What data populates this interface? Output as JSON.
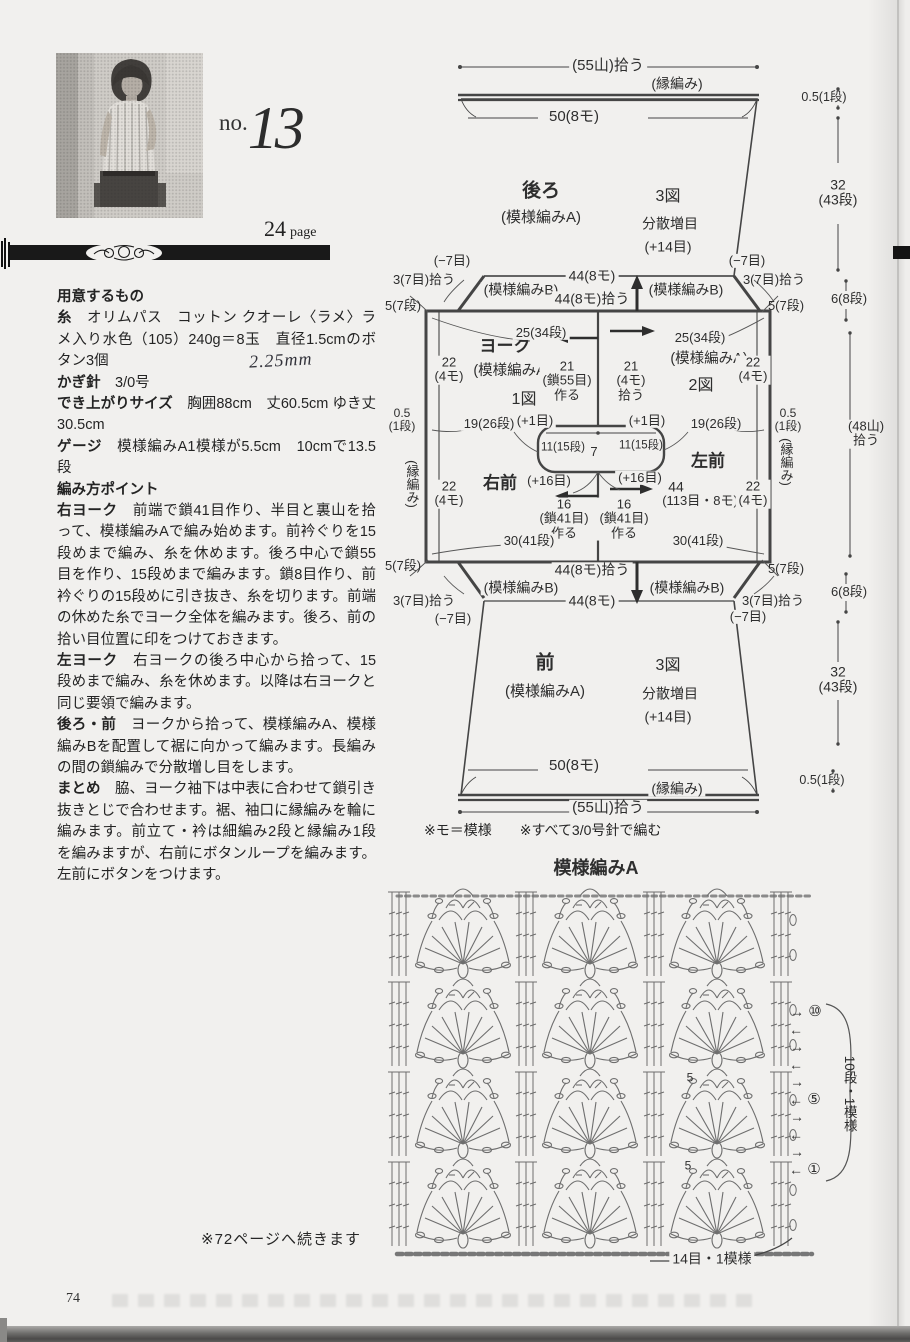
{
  "header": {
    "no_prefix": "no.",
    "no_number": "13",
    "page_ref_number": "24",
    "page_ref_label": "page"
  },
  "instructions": {
    "paragraphs": [
      {
        "h": "用意するもの"
      },
      {
        "b": "糸",
        "t": "　オリムパス　コットン クオーレ〈ラメ〉ラメ入り水色（105）240g＝8玉　直径1.5cmのボタン3個"
      },
      {
        "b": "かぎ針",
        "t": "　3/0号"
      },
      {
        "b": "でき上がりサイズ",
        "t": "　胸囲88cm　丈60.5cm ゆき丈30.5cm"
      },
      {
        "b": "ゲージ",
        "t": "　模様編みA1模様が5.5cm　10cmで13.5段"
      },
      {
        "h": "編み方ポイント"
      },
      {
        "b": "右ヨーク",
        "t": "　前端で鎖41目作り、半目と裏山を拾って、模様編みAで編み始めます。前衿ぐりを15段めまで編み、糸を休めます。後ろ中心で鎖55目を作り、15段めまで編みます。鎖8目作り、前衿ぐりの15段めに引き抜き、糸を切ります。前端の休めた糸でヨーク全体を編みます。後ろ、前の拾い目位置に印をつけておきます。"
      },
      {
        "b": "左ヨーク",
        "t": "　右ヨークの後ろ中心から拾って、15段めまで編み、糸を休めます。以降は右ヨークと同じ要領で編みます。"
      },
      {
        "b": "後ろ・前",
        "t": "　ヨークから拾って、模様編みA、模様編みBを配置して裾に向かって編みます。長編みの間の鎖編みで分散増し目をします。"
      },
      {
        "b": "まとめ",
        "t": "　脇、ヨーク袖下は中表に合わせて鎖引き抜きとじで合わせます。裾、袖口に縁編みを輪に編みます。前立て・衿は細編み2段と縁編み1段を編みますが、右前にボタンループを編みます。左前にボタンをつけます。"
      }
    ],
    "handwritten_note": "2.25mm"
  },
  "schematic": {
    "footnote": "※モ＝模様　　※すべて3/0号針で編む",
    "labels": [
      {
        "t": "(55山)拾う",
        "x": 608,
        "y": 66,
        "s": 15,
        "bg": 1
      },
      {
        "t": "(縁編み)",
        "x": 677,
        "y": 84,
        "s": 14,
        "bg": 1
      },
      {
        "t": "50(8モ)",
        "x": 574,
        "y": 117,
        "s": 15,
        "bg": 1
      },
      {
        "t": "後ろ",
        "x": 541,
        "y": 192,
        "s": 19,
        "b": 1
      },
      {
        "t": "(模様編みA)",
        "x": 541,
        "y": 218,
        "s": 15
      },
      {
        "t": "3図",
        "x": 668,
        "y": 197,
        "s": 16
      },
      {
        "t": "分散増目",
        "x": 670,
        "y": 224,
        "s": 14
      },
      {
        "t": "(+14目)",
        "x": 668,
        "y": 247,
        "s": 14
      },
      {
        "t": "0.5(1段)",
        "x": 824,
        "y": 98,
        "s": 12.5,
        "bg": 1
      },
      {
        "t": "32\n(43段)",
        "x": 838,
        "y": 193,
        "s": 14,
        "bg": 1
      },
      {
        "t": "(−7目)",
        "x": 452,
        "y": 261,
        "s": 13,
        "bg": 1
      },
      {
        "t": "(−7目)",
        "x": 747,
        "y": 261,
        "s": 13,
        "bg": 1
      },
      {
        "t": "44(8モ)",
        "x": 592,
        "y": 276,
        "s": 14,
        "bg": 1
      },
      {
        "t": "3(7目)拾う",
        "x": 424,
        "y": 280,
        "s": 13
      },
      {
        "t": "3(7目)拾う",
        "x": 774,
        "y": 280,
        "s": 13
      },
      {
        "t": "(模様編みB)",
        "x": 521,
        "y": 290,
        "s": 14,
        "bg": 1
      },
      {
        "t": "(模様編みB)",
        "x": 686,
        "y": 290,
        "s": 14,
        "bg": 1
      },
      {
        "t": "44(8モ)拾う",
        "x": 592,
        "y": 299,
        "s": 14,
        "bg": 1
      },
      {
        "t": "5(7段)",
        "x": 403,
        "y": 306,
        "s": 13
      },
      {
        "t": "5(7段)",
        "x": 786,
        "y": 306,
        "s": 13
      },
      {
        "t": "6(8段)",
        "x": 849,
        "y": 299,
        "s": 13,
        "bg": 1
      },
      {
        "t": "ヨーク",
        "x": 505,
        "y": 347,
        "s": 17,
        "b": 1
      },
      {
        "t": "(模様編みA)",
        "x": 512,
        "y": 372,
        "s": 14.5
      },
      {
        "t": "1図",
        "x": 524,
        "y": 400,
        "s": 16
      },
      {
        "t": "25(34段)",
        "x": 541,
        "y": 333,
        "s": 13,
        "bg": 1
      },
      {
        "t": "25(34段)",
        "x": 700,
        "y": 338,
        "s": 13,
        "bg": 1
      },
      {
        "t": "21\n(鎖55目)\n作る",
        "x": 567,
        "y": 381,
        "s": 13,
        "bg": 1
      },
      {
        "t": "21\n(4モ)\n拾う",
        "x": 631,
        "y": 381,
        "s": 13,
        "bg": 1
      },
      {
        "t": "(模様編みA)",
        "x": 709,
        "y": 360,
        "s": 14.5
      },
      {
        "t": "2図",
        "x": 701,
        "y": 386,
        "s": 16
      },
      {
        "t": "22\n(4モ)",
        "x": 449,
        "y": 370,
        "s": 13,
        "bg": 1
      },
      {
        "t": "22\n(4モ)",
        "x": 753,
        "y": 370,
        "s": 13,
        "bg": 1
      },
      {
        "t": "0.5\n(1段)",
        "x": 402,
        "y": 420,
        "s": 12
      },
      {
        "t": "0.5\n(1段)",
        "x": 788,
        "y": 420,
        "s": 12
      },
      {
        "t": "19(26段)",
        "x": 489,
        "y": 424,
        "s": 13,
        "bg": 1
      },
      {
        "t": "19(26段)",
        "x": 716,
        "y": 424,
        "s": 13,
        "bg": 1
      },
      {
        "t": "(+1目)",
        "x": 535,
        "y": 421,
        "s": 13,
        "bg": 1
      },
      {
        "t": "(+1目)",
        "x": 647,
        "y": 421,
        "s": 13,
        "bg": 1
      },
      {
        "t": "(48山)\n拾う",
        "x": 866,
        "y": 434,
        "s": 13,
        "bg": 1
      },
      {
        "t": "11(15段)",
        "x": 563,
        "y": 448,
        "s": 11.5
      },
      {
        "t": "7",
        "x": 594,
        "y": 452,
        "s": 13
      },
      {
        "t": "11(15段)",
        "x": 641,
        "y": 446,
        "s": 11.5
      },
      {
        "t": "(+16目)",
        "x": 549,
        "y": 481,
        "s": 13,
        "bg": 1
      },
      {
        "t": "(+16目)",
        "x": 640,
        "y": 478,
        "s": 13,
        "bg": 1
      },
      {
        "t": "右前",
        "x": 500,
        "y": 484,
        "s": 17,
        "b": 1
      },
      {
        "t": "左前",
        "x": 708,
        "y": 462,
        "s": 17,
        "b": 1
      },
      {
        "t": "44",
        "x": 676,
        "y": 487,
        "s": 14
      },
      {
        "t": "16\n(鎖41目)\n作る",
        "x": 564,
        "y": 519,
        "s": 13,
        "bg": 1
      },
      {
        "t": "16\n(鎖41目)\n作る",
        "x": 624,
        "y": 519,
        "s": 13,
        "bg": 1
      },
      {
        "t": "(113目・8モ)",
        "x": 700,
        "y": 501,
        "s": 13
      },
      {
        "t": "(縁編み)",
        "x": 412,
        "y": 484,
        "s": 13,
        "v": 1
      },
      {
        "t": "(縁編み)",
        "x": 786,
        "y": 462,
        "s": 13,
        "v": 1
      },
      {
        "t": "22\n(4モ)",
        "x": 449,
        "y": 494,
        "s": 13,
        "bg": 1
      },
      {
        "t": "22\n(4モ)",
        "x": 753,
        "y": 494,
        "s": 13,
        "bg": 1
      },
      {
        "t": "30(41段)",
        "x": 529,
        "y": 541,
        "s": 13,
        "bg": 1
      },
      {
        "t": "30(41段)",
        "x": 698,
        "y": 541,
        "s": 13,
        "bg": 1
      },
      {
        "t": "5(7段)",
        "x": 403,
        "y": 566,
        "s": 13
      },
      {
        "t": "5(7段)",
        "x": 786,
        "y": 569,
        "s": 13
      },
      {
        "t": "44(8モ)拾う",
        "x": 592,
        "y": 570,
        "s": 14,
        "bg": 1
      },
      {
        "t": "(模様編みB)",
        "x": 521,
        "y": 588,
        "s": 14,
        "bg": 1
      },
      {
        "t": "(模様編みB)",
        "x": 687,
        "y": 588,
        "s": 14,
        "bg": 1
      },
      {
        "t": "3(7目)拾う",
        "x": 424,
        "y": 601,
        "s": 13
      },
      {
        "t": "3(7目)拾う",
        "x": 773,
        "y": 601,
        "s": 13
      },
      {
        "t": "44(8モ)",
        "x": 592,
        "y": 601,
        "s": 14,
        "bg": 1
      },
      {
        "t": "6(8段)",
        "x": 849,
        "y": 592,
        "s": 13,
        "bg": 1
      },
      {
        "t": "(−7目)",
        "x": 453,
        "y": 619,
        "s": 13,
        "bg": 1
      },
      {
        "t": "(−7目)",
        "x": 748,
        "y": 617,
        "s": 13,
        "bg": 1
      },
      {
        "t": "前",
        "x": 545,
        "y": 664,
        "s": 19,
        "b": 1
      },
      {
        "t": "(模様編みA)",
        "x": 545,
        "y": 692,
        "s": 15
      },
      {
        "t": "3図",
        "x": 668,
        "y": 666,
        "s": 16
      },
      {
        "t": "分散増目",
        "x": 670,
        "y": 694,
        "s": 14
      },
      {
        "t": "(+14目)",
        "x": 668,
        "y": 717,
        "s": 14
      },
      {
        "t": "32\n(43段)",
        "x": 838,
        "y": 680,
        "s": 14,
        "bg": 1
      },
      {
        "t": "50(8モ)",
        "x": 574,
        "y": 766,
        "s": 15,
        "bg": 1
      },
      {
        "t": "(縁編み)",
        "x": 677,
        "y": 789,
        "s": 14,
        "bg": 1
      },
      {
        "t": "(55山)拾う",
        "x": 608,
        "y": 808,
        "s": 15,
        "bg": 1
      },
      {
        "t": "0.5(1段)",
        "x": 822,
        "y": 781,
        "s": 12.5,
        "bg": 1
      }
    ]
  },
  "stitch_chart": {
    "title": "模様編みA",
    "bottom_label": "14目・1模様",
    "side_label": "10段・1模様",
    "labels": [
      {
        "t": "模様編みA",
        "x": 596,
        "y": 869,
        "s": 18,
        "b": 1,
        "n": "stitch-chart-title"
      },
      {
        "t": "5",
        "x": 690,
        "y": 1078,
        "s": 12,
        "n": "chart-stitch-count"
      },
      {
        "t": "5",
        "x": 688,
        "y": 1166,
        "s": 12,
        "n": "chart-stitch-count"
      },
      {
        "t": "→",
        "x": 797,
        "y": 1012,
        "s": 14,
        "n": "row-direction-arrow"
      },
      {
        "t": "←",
        "x": 796,
        "y": 1030,
        "s": 14,
        "n": "row-direction-arrow"
      },
      {
        "t": "→",
        "x": 797,
        "y": 1047,
        "s": 14,
        "n": "row-direction-arrow"
      },
      {
        "t": "←",
        "x": 796,
        "y": 1065,
        "s": 14,
        "n": "row-direction-arrow"
      },
      {
        "t": "→",
        "x": 797,
        "y": 1082,
        "s": 14,
        "n": "row-direction-arrow"
      },
      {
        "t": "←",
        "x": 796,
        "y": 1100,
        "s": 14,
        "n": "row-direction-arrow"
      },
      {
        "t": "→",
        "x": 797,
        "y": 1117,
        "s": 14,
        "n": "row-direction-arrow"
      },
      {
        "t": "←",
        "x": 796,
        "y": 1135,
        "s": 14,
        "n": "row-direction-arrow"
      },
      {
        "t": "→",
        "x": 797,
        "y": 1152,
        "s": 14,
        "n": "row-direction-arrow"
      },
      {
        "t": "←",
        "x": 796,
        "y": 1170,
        "s": 14,
        "n": "row-direction-arrow"
      },
      {
        "t": "⑩",
        "x": 815,
        "y": 1012,
        "s": 15,
        "n": "row-number-10"
      },
      {
        "t": "⑤",
        "x": 814,
        "y": 1100,
        "s": 15,
        "n": "row-number-5"
      },
      {
        "t": "①",
        "x": 814,
        "y": 1170,
        "s": 15,
        "n": "row-number-1"
      },
      {
        "t": "10段・1模様",
        "x": 849,
        "y": 1094,
        "s": 13.5,
        "v": 1,
        "n": "chart-side-label"
      },
      {
        "t": "14目・1模様",
        "x": 712,
        "y": 1259,
        "s": 14,
        "bg": 1,
        "n": "chart-bottom-label"
      }
    ]
  },
  "footer": {
    "continuation_note": "※72ページへ続きます",
    "page_number": "74"
  }
}
